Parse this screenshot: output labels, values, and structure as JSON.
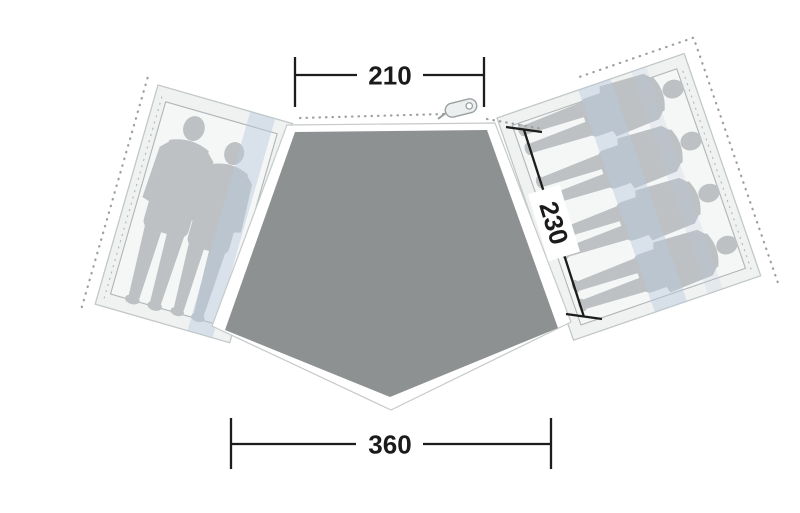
{
  "diagram": {
    "kind": "tent-floorplan-top-view",
    "dimensions": {
      "door_width": "210",
      "bedroom_depth": "230",
      "base_width": "360"
    },
    "left_bedroom": {
      "occupants": 2
    },
    "right_bedroom": {
      "occupants": 4
    },
    "colors": {
      "floor": "#8d9191",
      "panel": "#f0f2f2",
      "panel_stroke": "#c2c7c7",
      "inner_fill": "#f5f6f6",
      "inner_stroke": "#b0b5b5",
      "figure": "#bdc1c3",
      "stripe": "#b9c9dd",
      "dots": "#9ba1a1",
      "dim_line": "#1d1d1b",
      "label_text": "#1b1b1b",
      "zipper_fill": "#ecefef",
      "zipper_stroke": "#9aa0a0",
      "underlay_stroke": "#c6caca"
    }
  }
}
